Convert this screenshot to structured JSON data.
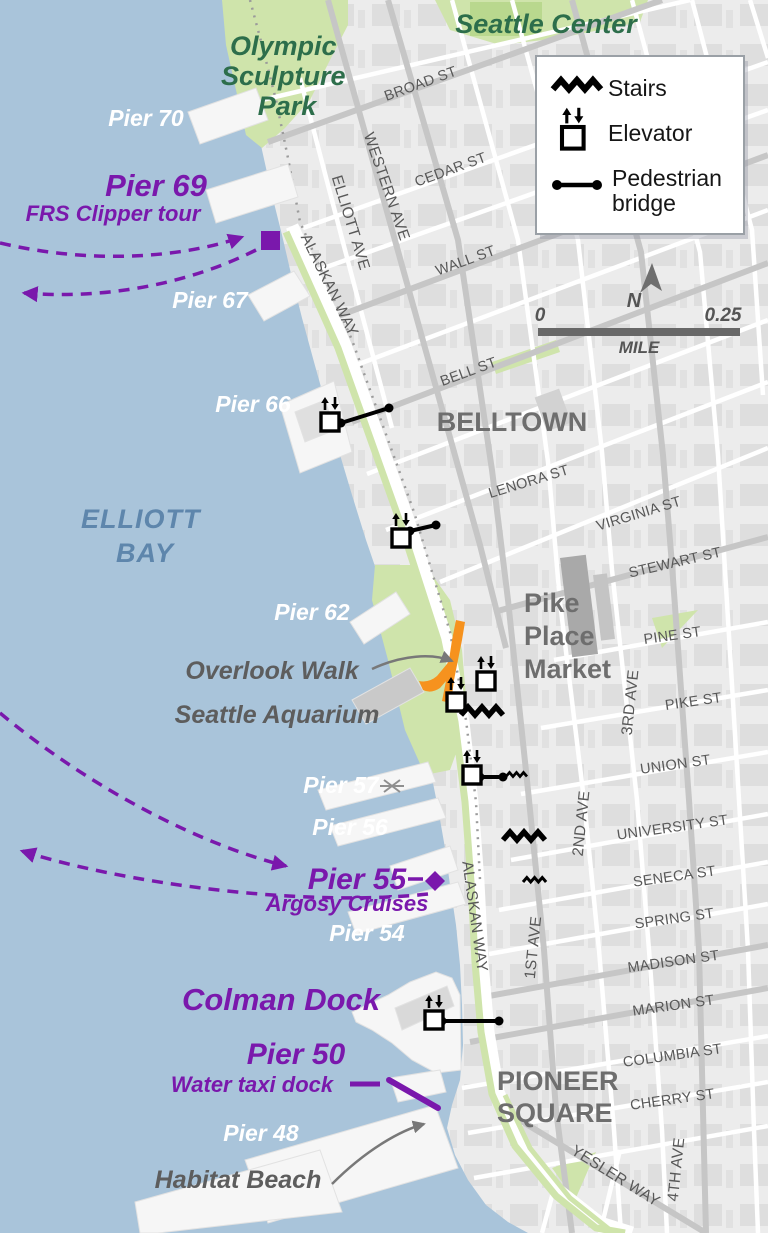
{
  "colors": {
    "water": "#a9c4da",
    "land": "#ececec",
    "block": "#dddddd",
    "road_major": "#c6c6c6",
    "road_minor": "#ffffff",
    "park_green": "#cfe4ab",
    "park_green_dark": "#b9d88e",
    "label_green": "#2d6e4b",
    "purple": "#7a18ac",
    "orange": "#f6921e",
    "bay_blue": "#5e86ac",
    "gray_label": "#5d5d5d",
    "street_label": "#585858",
    "hood_label": "#6e6e6e"
  },
  "legend": {
    "stairs": "Stairs",
    "elevator": "Elevator",
    "pedestrian_bridge": [
      "Pedestrian",
      "bridge"
    ]
  },
  "compass": {
    "north": "N"
  },
  "scalebar": {
    "start": "0",
    "end": "0.25",
    "unit": "MILE"
  },
  "places": {
    "seattle_center": "Seattle Center",
    "olympic_sculpture_park": [
      "Olympic",
      "Sculpture",
      "Park"
    ],
    "elliott_bay": [
      "ELLIOTT",
      "BAY"
    ],
    "belltown": "BELLTOWN",
    "pike_place_market": [
      "Pike",
      "Place",
      "Market"
    ],
    "pioneer_square": [
      "PIONEER",
      "SQUARE"
    ],
    "overlook_walk": "Overlook Walk",
    "seattle_aquarium": "Seattle Aquarium",
    "habitat_beach": "Habitat Beach"
  },
  "piers": {
    "pier_70": "Pier 70",
    "pier_69": "Pier 69",
    "pier_69_sub": "FRS Clipper tour",
    "pier_67": "Pier 67",
    "pier_66": "Pier 66",
    "pier_62": "Pier 62",
    "pier_57": "Pier 57",
    "pier_56": "Pier 56",
    "pier_55": "Pier 55",
    "pier_55_sub": "Argosy Cruises",
    "pier_54": "Pier 54",
    "colman_dock": "Colman Dock",
    "pier_50": "Pier 50",
    "pier_50_sub": "Water taxi dock",
    "pier_48": "Pier 48"
  },
  "streets": {
    "broad_st": "BROAD ST",
    "cedar_st": "CEDAR ST",
    "wall_st": "WALL ST",
    "bell_st": "BELL ST",
    "lenora_st": "LENORA ST",
    "virginia_st": "VIRGINIA ST",
    "stewart_st": "STEWART ST",
    "pine_st": "PINE ST",
    "pike_st": "PIKE ST",
    "union_st": "UNION ST",
    "university_st": "UNIVERSITY ST",
    "seneca_st": "SENECA ST",
    "spring_st": "SPRING ST",
    "madison_st": "MADISON ST",
    "marion_st": "MARION ST",
    "columbia_st": "COLUMBIA ST",
    "cherry_st": "CHERRY ST",
    "yesler_way": "YESLER WAY",
    "western_ave": "WESTERN AVE",
    "elliott_ave": "ELLIOTT AVE",
    "alaskan_way": "ALASKAN WAY",
    "first_ave": "1ST AVE",
    "second_ave": "2ND AVE",
    "third_ave": "3RD AVE",
    "fourth_ave": "4TH AVE"
  }
}
